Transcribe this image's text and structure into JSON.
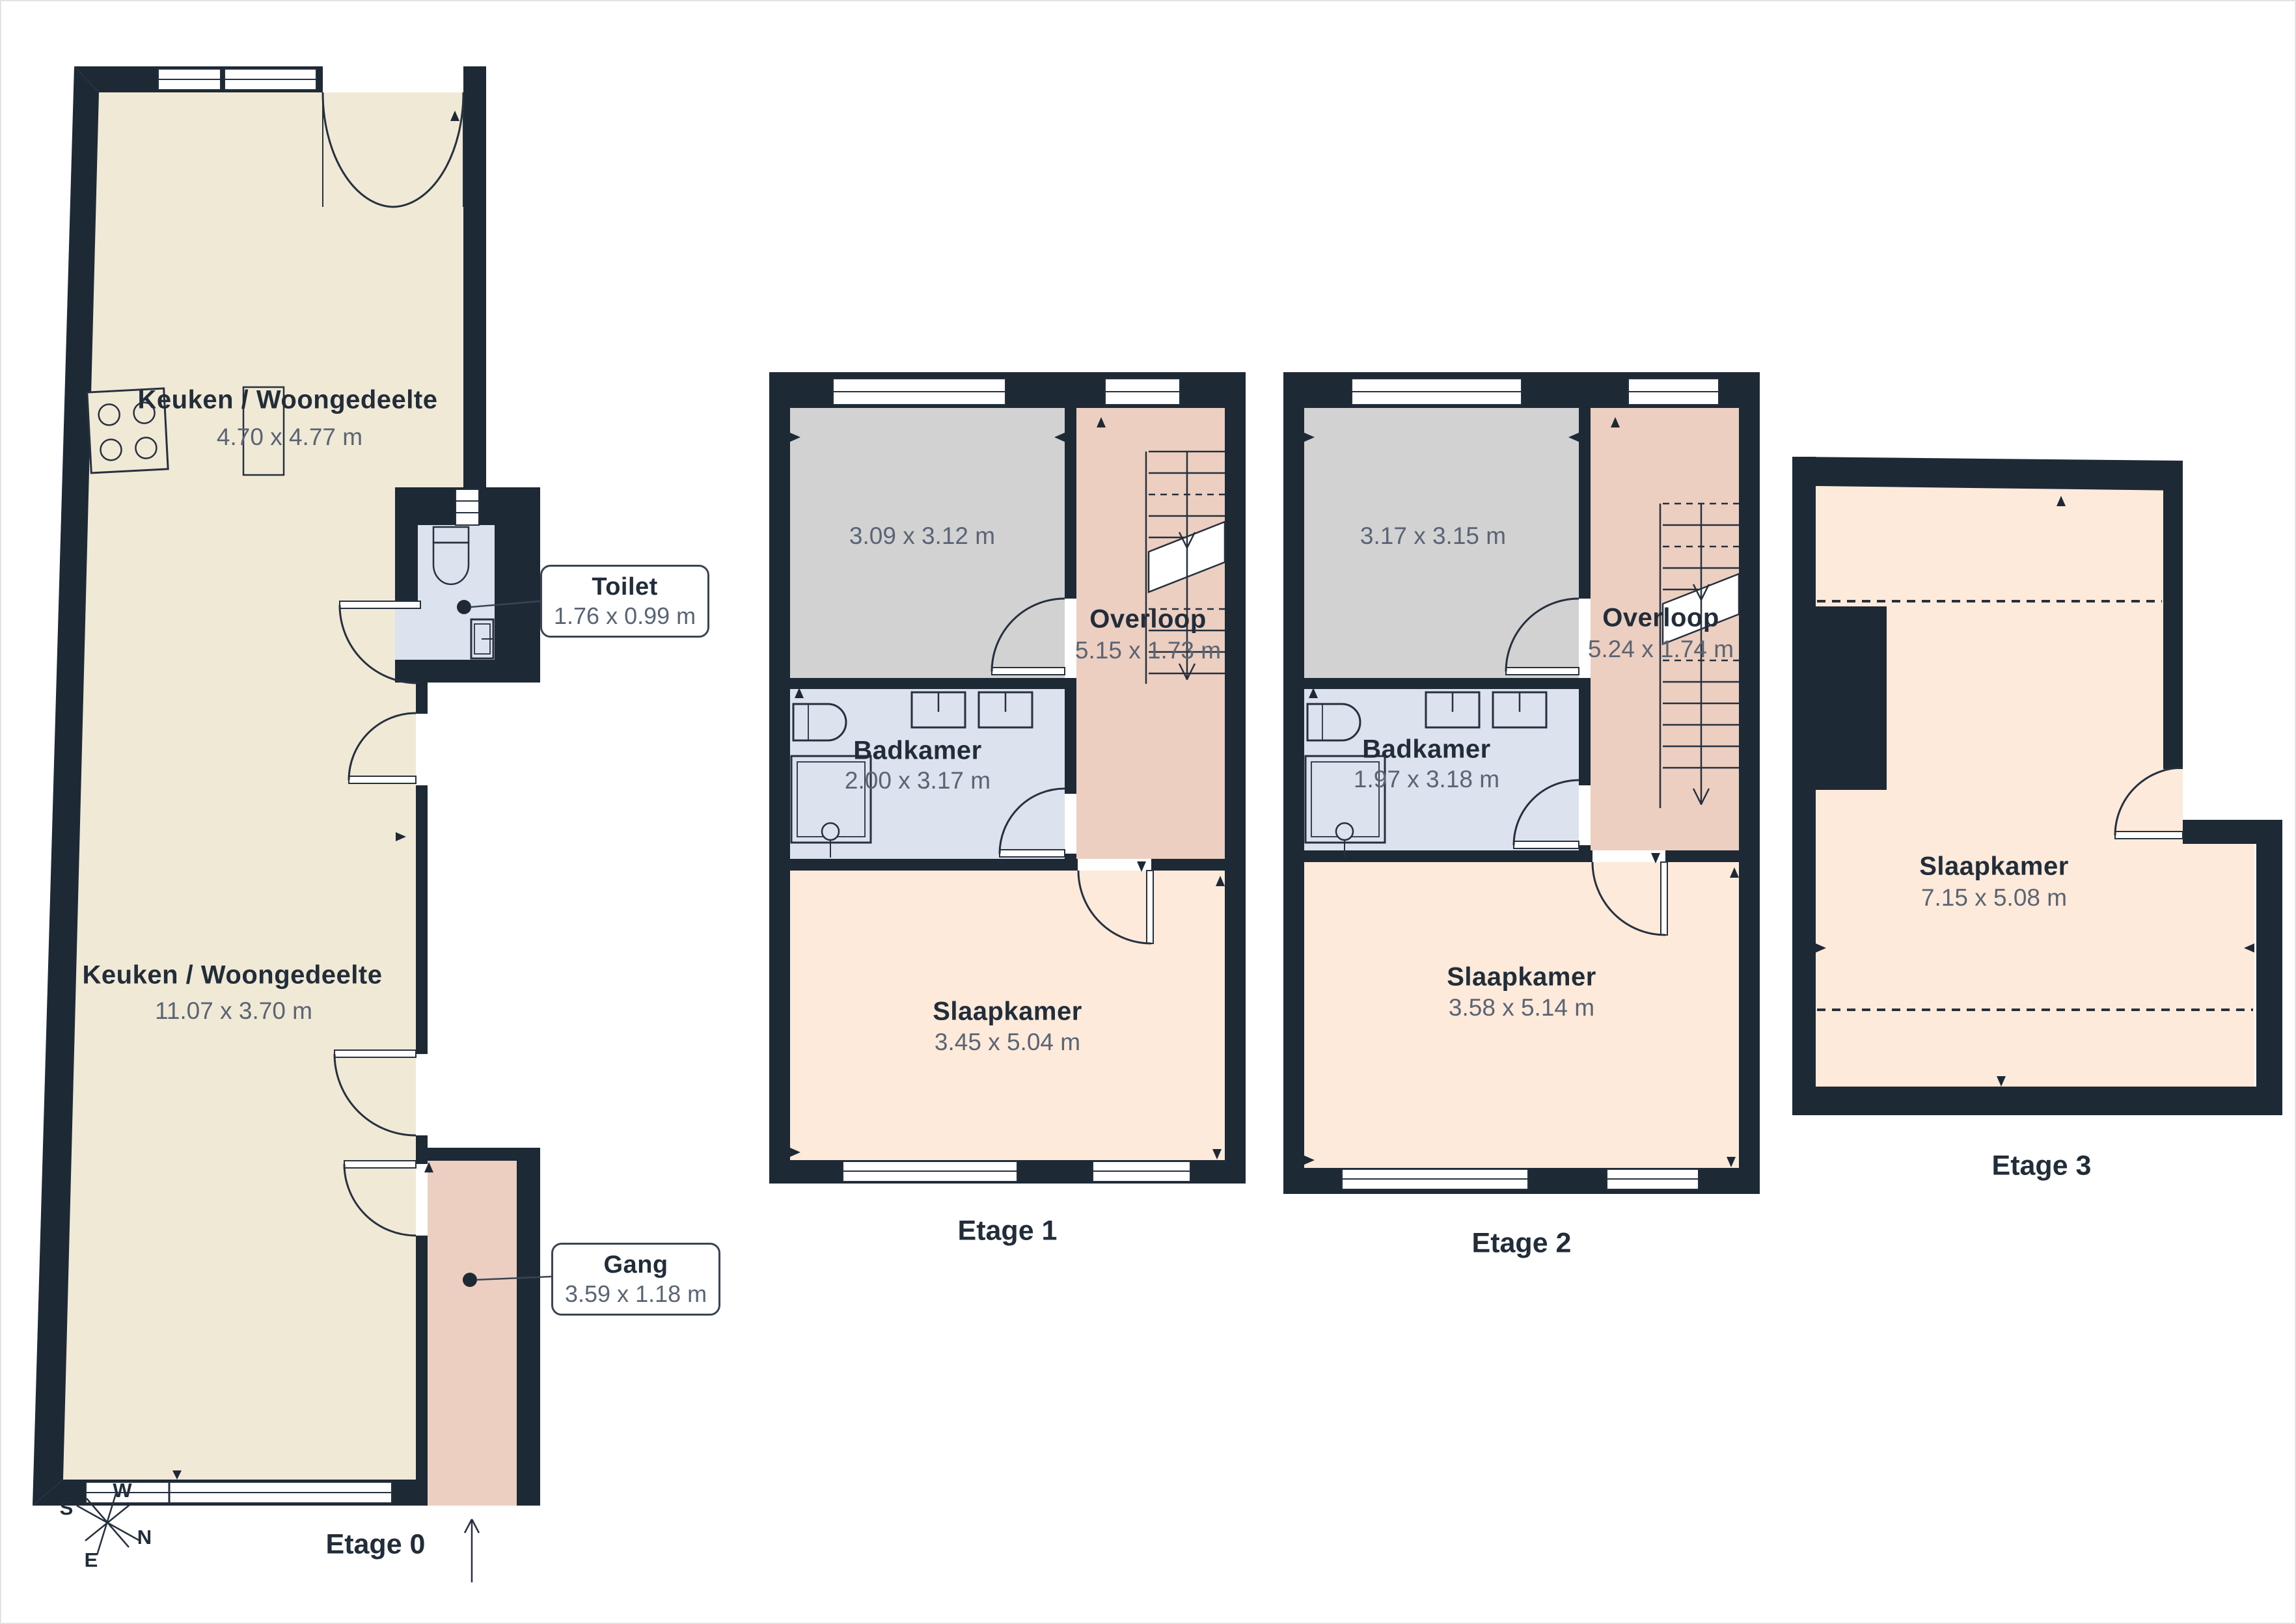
{
  "colors": {
    "wall": "#1e2936",
    "line": "#26303e",
    "floor_cream": "#f0e9d6",
    "floor_peach": "#fdeada",
    "floor_salmon": "#eccfc0",
    "floor_bath": "#dce2ee",
    "floor_gray": "#d2d2d2",
    "text_name": "#222d3a",
    "text_dims": "#5a6474"
  },
  "floors": [
    {
      "label": "Etage 0",
      "rooms": [
        {
          "name": "Keuken / Woongedeelte",
          "dims": "4.70 x 4.77 m"
        },
        {
          "name": "Keuken / Woongedeelte",
          "dims": "11.07 x 3.70 m"
        }
      ],
      "callouts": [
        {
          "name": "Toilet",
          "dims": "1.76 x 0.99 m"
        },
        {
          "name": "Gang",
          "dims": "3.59 x 1.18 m"
        }
      ],
      "compass": {
        "n": "N",
        "e": "E",
        "s": "S",
        "w": "W"
      }
    },
    {
      "label": "Etage 1",
      "rooms": [
        {
          "name": "",
          "dims": "3.09 x 3.12 m"
        },
        {
          "name": "Overloop",
          "dims": "5.15 x 1.73 m"
        },
        {
          "name": "Badkamer",
          "dims": "2.00 x 3.17 m"
        },
        {
          "name": "Slaapkamer",
          "dims": "3.45 x 5.04 m"
        }
      ]
    },
    {
      "label": "Etage 2",
      "rooms": [
        {
          "name": "",
          "dims": "3.17 x 3.15 m"
        },
        {
          "name": "Overloop",
          "dims": "5.24 x 1.74 m"
        },
        {
          "name": "Badkamer",
          "dims": "1.97 x 3.18 m"
        },
        {
          "name": "Slaapkamer",
          "dims": "3.58 x 5.14 m"
        }
      ]
    },
    {
      "label": "Etage 3",
      "rooms": [
        {
          "name": "Slaapkamer",
          "dims": "7.15 x 5.08 m"
        }
      ]
    }
  ]
}
